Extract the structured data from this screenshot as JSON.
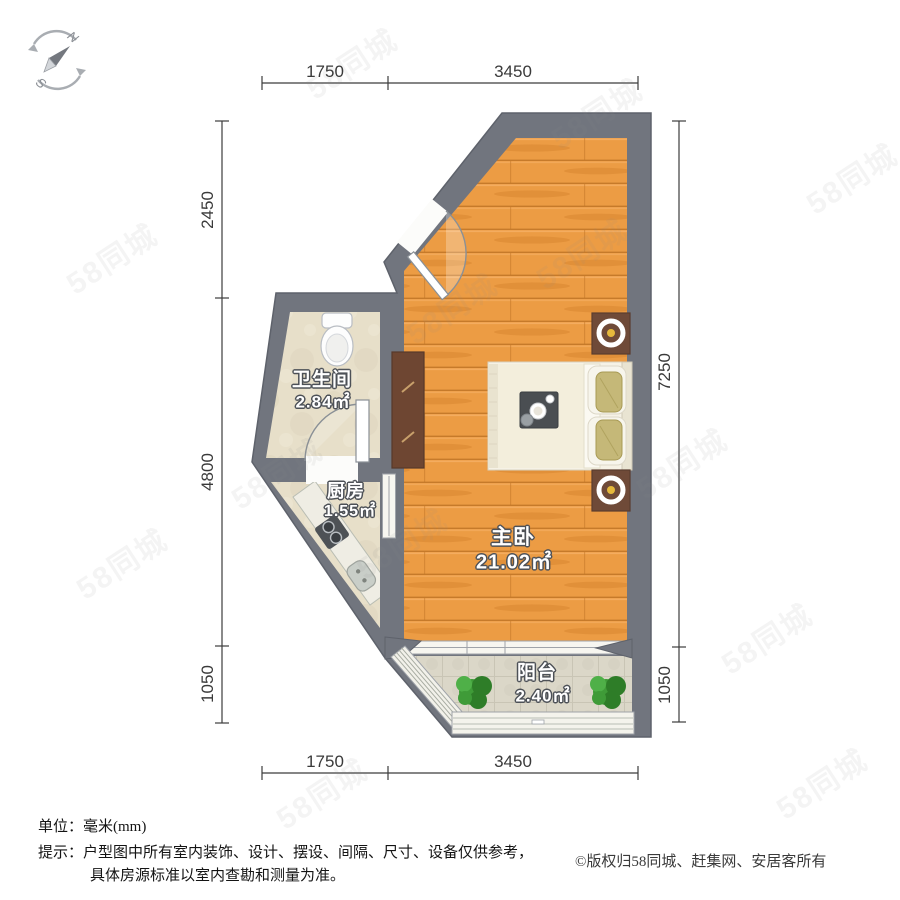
{
  "compass": {
    "north_label": "N",
    "south_label": "S"
  },
  "dimensions": {
    "top": [
      {
        "label": "1750"
      },
      {
        "label": "3450"
      }
    ],
    "bottom": [
      {
        "label": "1750"
      },
      {
        "label": "3450"
      }
    ],
    "left": [
      {
        "label": "2450"
      },
      {
        "label": "4800"
      },
      {
        "label": "1050"
      }
    ],
    "right": [
      {
        "label": "7250"
      },
      {
        "label": "1050"
      }
    ]
  },
  "rooms": [
    {
      "id": "bathroom",
      "name": "卫生间",
      "area": "2.84㎡"
    },
    {
      "id": "kitchen",
      "name": "厨房",
      "area": "1.55㎡"
    },
    {
      "id": "bedroom",
      "name": "主卧",
      "area": "21.02㎡"
    },
    {
      "id": "balcony",
      "name": "阳台",
      "area": "2.40㎡"
    }
  ],
  "footer": {
    "unit_line": "单位：毫米(mm)",
    "tip_line1": "提示：户型图中所有室内装饰、设计、摆设、间隔、尺寸、设备仅供参考，",
    "tip_line2": "具体房源标准以室内查勘和测量为准。",
    "copyright": "©版权归58同城、赶集网、安居客所有"
  },
  "watermark": {
    "text": "58同城",
    "positions": [
      {
        "x": 300,
        "y": 40
      },
      {
        "x": 60,
        "y": 235
      },
      {
        "x": 530,
        "y": 230
      },
      {
        "x": 225,
        "y": 450
      },
      {
        "x": 630,
        "y": 440
      },
      {
        "x": 70,
        "y": 540
      },
      {
        "x": 400,
        "y": 285
      },
      {
        "x": 350,
        "y": 520
      },
      {
        "x": 715,
        "y": 615
      },
      {
        "x": 270,
        "y": 770
      },
      {
        "x": 800,
        "y": 155
      },
      {
        "x": 545,
        "y": 90
      },
      {
        "x": 770,
        "y": 760
      }
    ]
  },
  "colors": {
    "wall": "#71757E",
    "wood_floor": "#EC9C44",
    "wood_grain": "#C07426",
    "tile_floor": "#E7DFC9",
    "balcony_tile": "#DBD7C8",
    "cabinet_brown": "#6E4632",
    "lamp_yellow": "#E6B93C",
    "plant_green": "#3F9B38",
    "bed_cream": "#F3EEDC",
    "dim_text": "#3A3A3A",
    "label_outline": "#4D5157"
  }
}
